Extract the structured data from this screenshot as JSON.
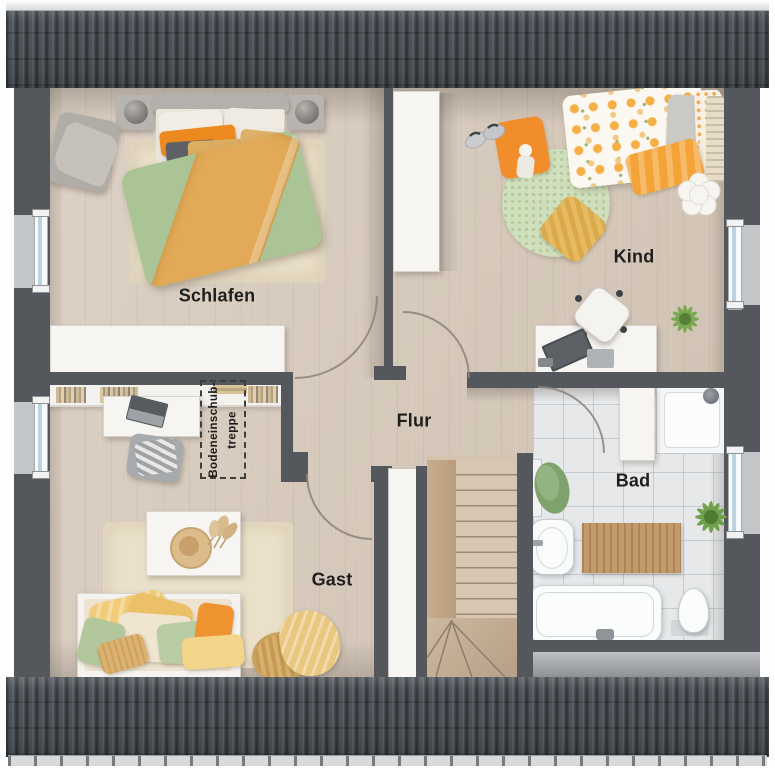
{
  "plan": {
    "type": "floor-plan",
    "floor_hint": "attic storey with staircase and loft hatch",
    "rooms": [
      {
        "id": "schlafen",
        "label": "Schlafen",
        "furniture": [
          "double-bed",
          "nightstand-left",
          "nightstand-right",
          "armchair",
          "rug",
          "sideboard"
        ]
      },
      {
        "id": "kind",
        "label": "Kind",
        "furniture": [
          "single-bed",
          "wardrobe",
          "round-rug",
          "floor-cushion",
          "doll",
          "slippers",
          "yellow-cushion",
          "desk",
          "desk-chair",
          "plant",
          "flower-rug"
        ]
      },
      {
        "id": "flur",
        "label": "Flur",
        "furniture": []
      },
      {
        "id": "gast",
        "label": "Gast",
        "furniture": [
          "bookshelf",
          "desk",
          "desk-chair",
          "coffee-table",
          "rug",
          "daybed",
          "basket",
          "blanket"
        ]
      },
      {
        "id": "bad",
        "label": "Bad",
        "furniture": [
          "shower",
          "cabinet",
          "towel",
          "sink",
          "bath-mat",
          "plant",
          "bathtub",
          "toilet"
        ]
      }
    ],
    "annotations": {
      "attic_hatch": {
        "line1": "Bodeneinschub-",
        "line2": "treppe"
      }
    },
    "stairs": {
      "name": "winder-staircase"
    },
    "windows": {
      "left": 2,
      "right": 2
    }
  },
  "colors": {
    "wall": "#54585C",
    "roof": "#474C51",
    "wood_floor": "#D8CBBC",
    "tile_floor": "#E6E8EA",
    "rug_cream": "#EADFC8",
    "duvet_green": "#ABC495",
    "accent_orange": "#ED8A1F",
    "accent_tan": "#DCAE61",
    "kid_rug_green": "#D0E0BC",
    "window_glass": "#BCD3E2",
    "label_text": "#1E1E1E"
  }
}
